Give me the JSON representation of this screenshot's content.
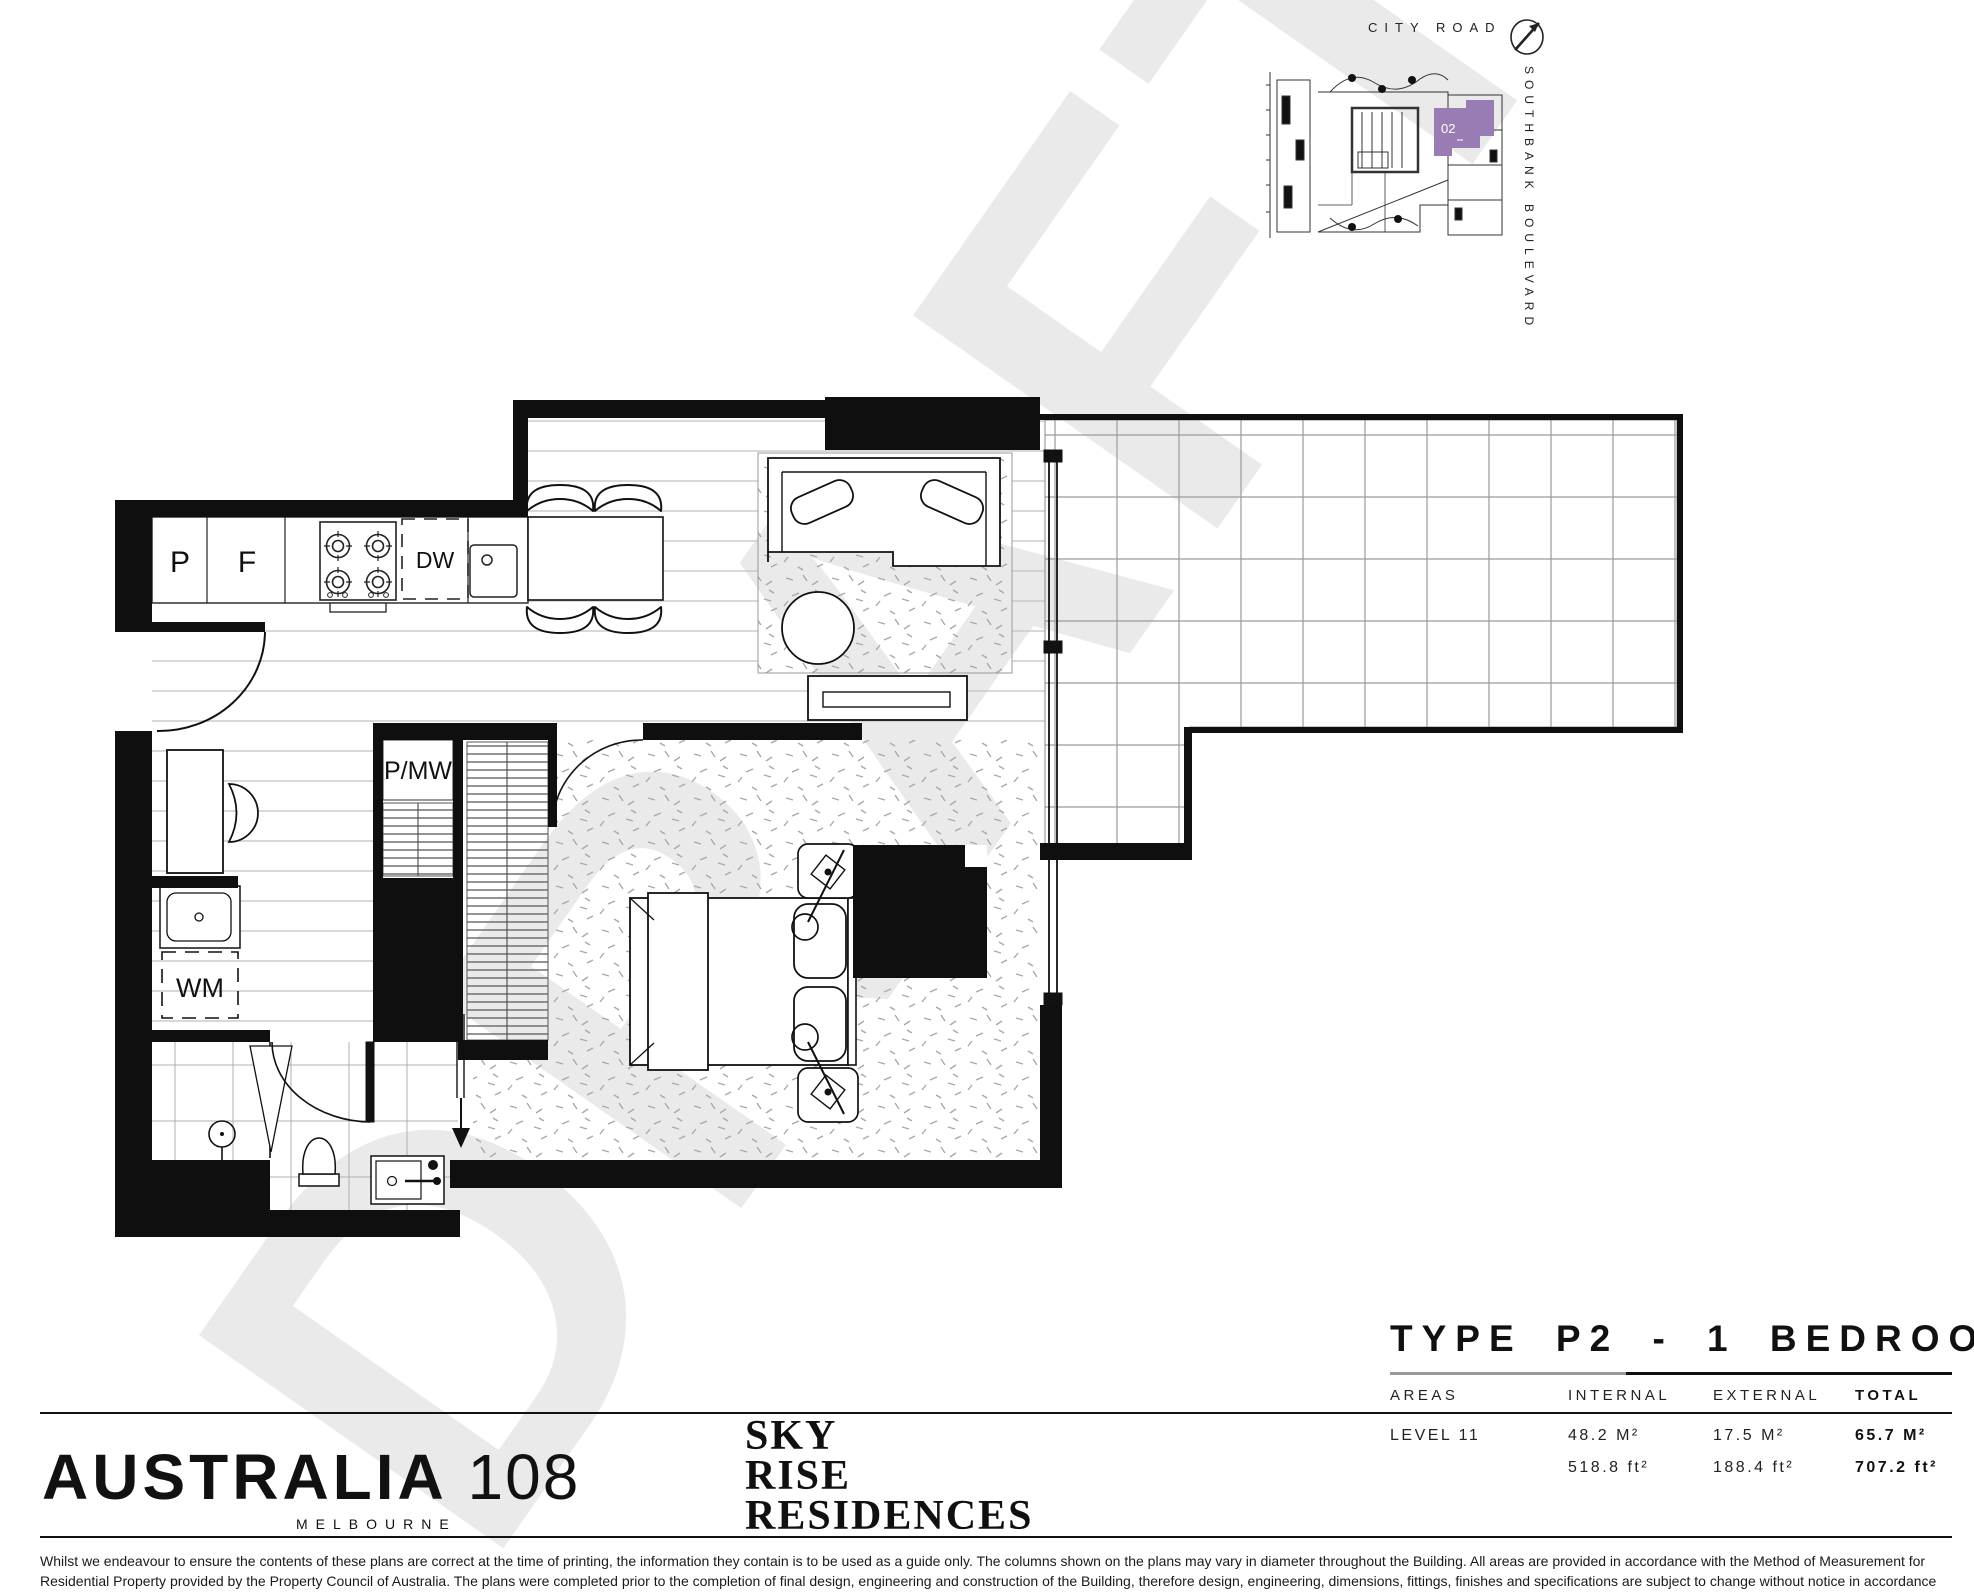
{
  "watermark": "DRAFT",
  "key_plan": {
    "street_top": "CITY ROAD",
    "street_right": "SOUTHBANK BOULEVARD",
    "unit_label": "02",
    "unit_color": "#9A7CB4"
  },
  "plan_labels": {
    "pantry": "P",
    "fridge": "F",
    "dishwasher": "DW",
    "pantry_microwave": "P/MW",
    "washing_machine": "WM"
  },
  "title_block": {
    "title": "TYPE P2 - 1 BEDROOM",
    "areas_label": "AREAS",
    "columns": [
      "INTERNAL",
      "EXTERNAL",
      "TOTAL"
    ],
    "row_label": "LEVEL 11",
    "metric": [
      "48.2 M²",
      "17.5 M²",
      "65.7 M²"
    ],
    "imperial": [
      "518.8 ft²",
      "188.4 ft²",
      "707.2 ft²"
    ]
  },
  "brand": {
    "name": "AUSTRALIA",
    "number": "108",
    "city": "MELBOURNE",
    "residence": [
      "SKY",
      "RISE",
      "RESIDENCES"
    ]
  },
  "disclaimer": "Whilst we endeavour to ensure the contents of these plans are correct at the time of printing, the information they contain is to be used as a guide only. The columns shown on the plans may vary in diameter throughout the Building. All areas are provided in accordance with the Method of Measurement for Residential Property provided by the Property Council of Australia. The plans were completed prior to the completion of final design, engineering and construction of the Building, therefore design, engineering, dimensions, fittings, finishes and specifications are subject to change without notice in accordance with the provisions of the Contract of Sale."
}
